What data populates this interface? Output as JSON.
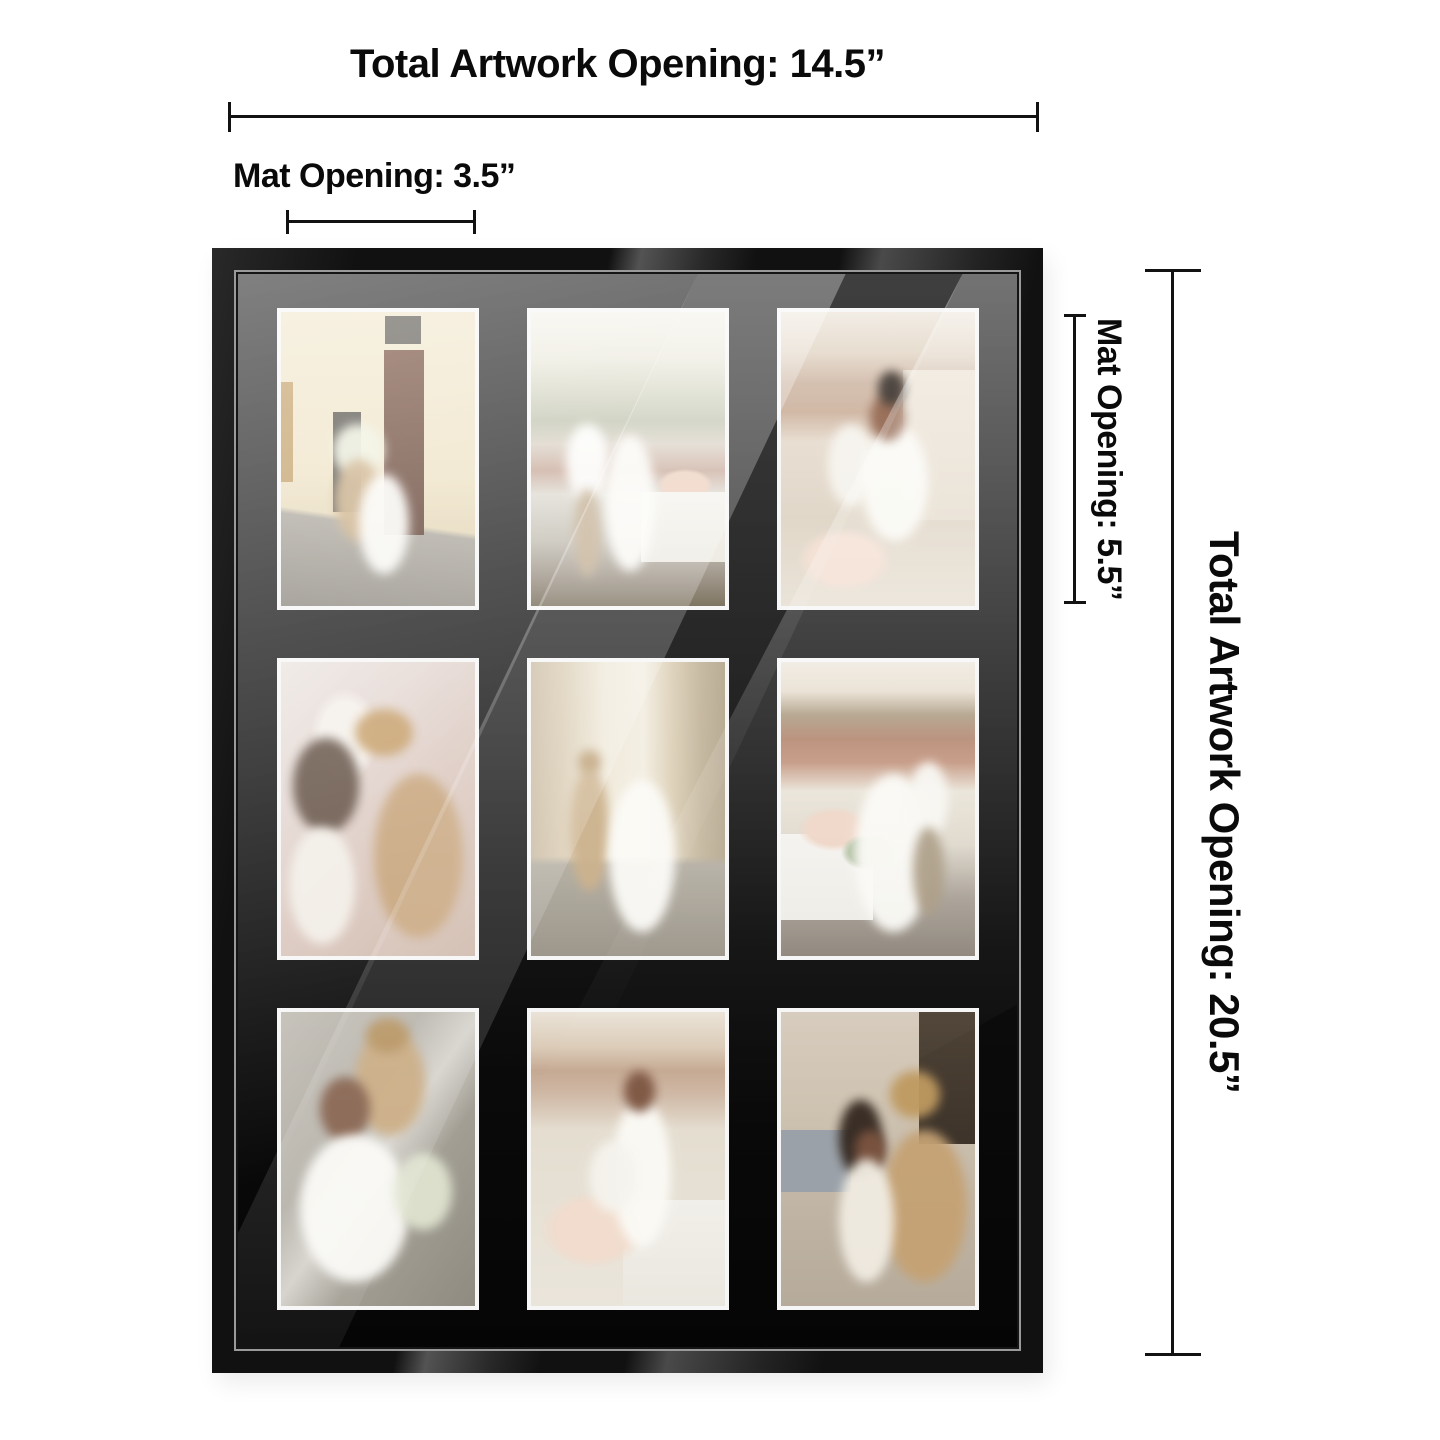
{
  "product": {
    "name": "9-Opening Collage Picture Frame with Black Mat",
    "frame_color": "black",
    "grid": {
      "rows": 3,
      "cols": 3,
      "photo_count": 9
    }
  },
  "annotations": {
    "top": {
      "total": "Total Artwork Opening: 14.5”",
      "mat": "Mat Opening: 3.5”"
    },
    "right": {
      "mat": "Mat Opening: 5.5”",
      "total": "Total Artwork Opening: 20.5”"
    }
  },
  "collage": {
    "photos": [
      {
        "alt": "Bride and groom embracing in a narrow Italian street beside a dark wooden door, bride lifting a white bouquet"
      },
      {
        "alt": "Couple kissing on a rooftop terrace, hazy hills behind and a white table with blush flowers at right"
      },
      {
        "alt": "Bride hugging seated groom from behind at a rooftop table with flowers and glassware, city buildings behind"
      },
      {
        "alt": "Close-up of couple dancing before a blurred cathedral facade, groom in straw hat and tan suit"
      },
      {
        "alt": "Couple walking away hand in hand down a cobbled street, bride's long white gown trailing"
      },
      {
        "alt": "Couple slow dancing on a rooftop deck beside a flower-covered table, red tiled roofs behind"
      },
      {
        "alt": "Groom in straw hat leaning over laughing bride against a gray stone wall, bouquet at her side"
      },
      {
        "alt": "Bride standing above seated groom at a rooftop table, large white and blush bouquet in the foreground"
      },
      {
        "alt": "Groom in straw hat kissing bride's cheek in a busy city square near a dark doorway"
      }
    ]
  },
  "colors": {
    "background": "#ffffff",
    "text": "#0a0a0a",
    "dimension_line": "#121212",
    "frame_moulding": "#111111",
    "frame_lip": "#9a9a9a",
    "mat": "#0b0b0b",
    "photo_border": "#f6f6f6"
  }
}
